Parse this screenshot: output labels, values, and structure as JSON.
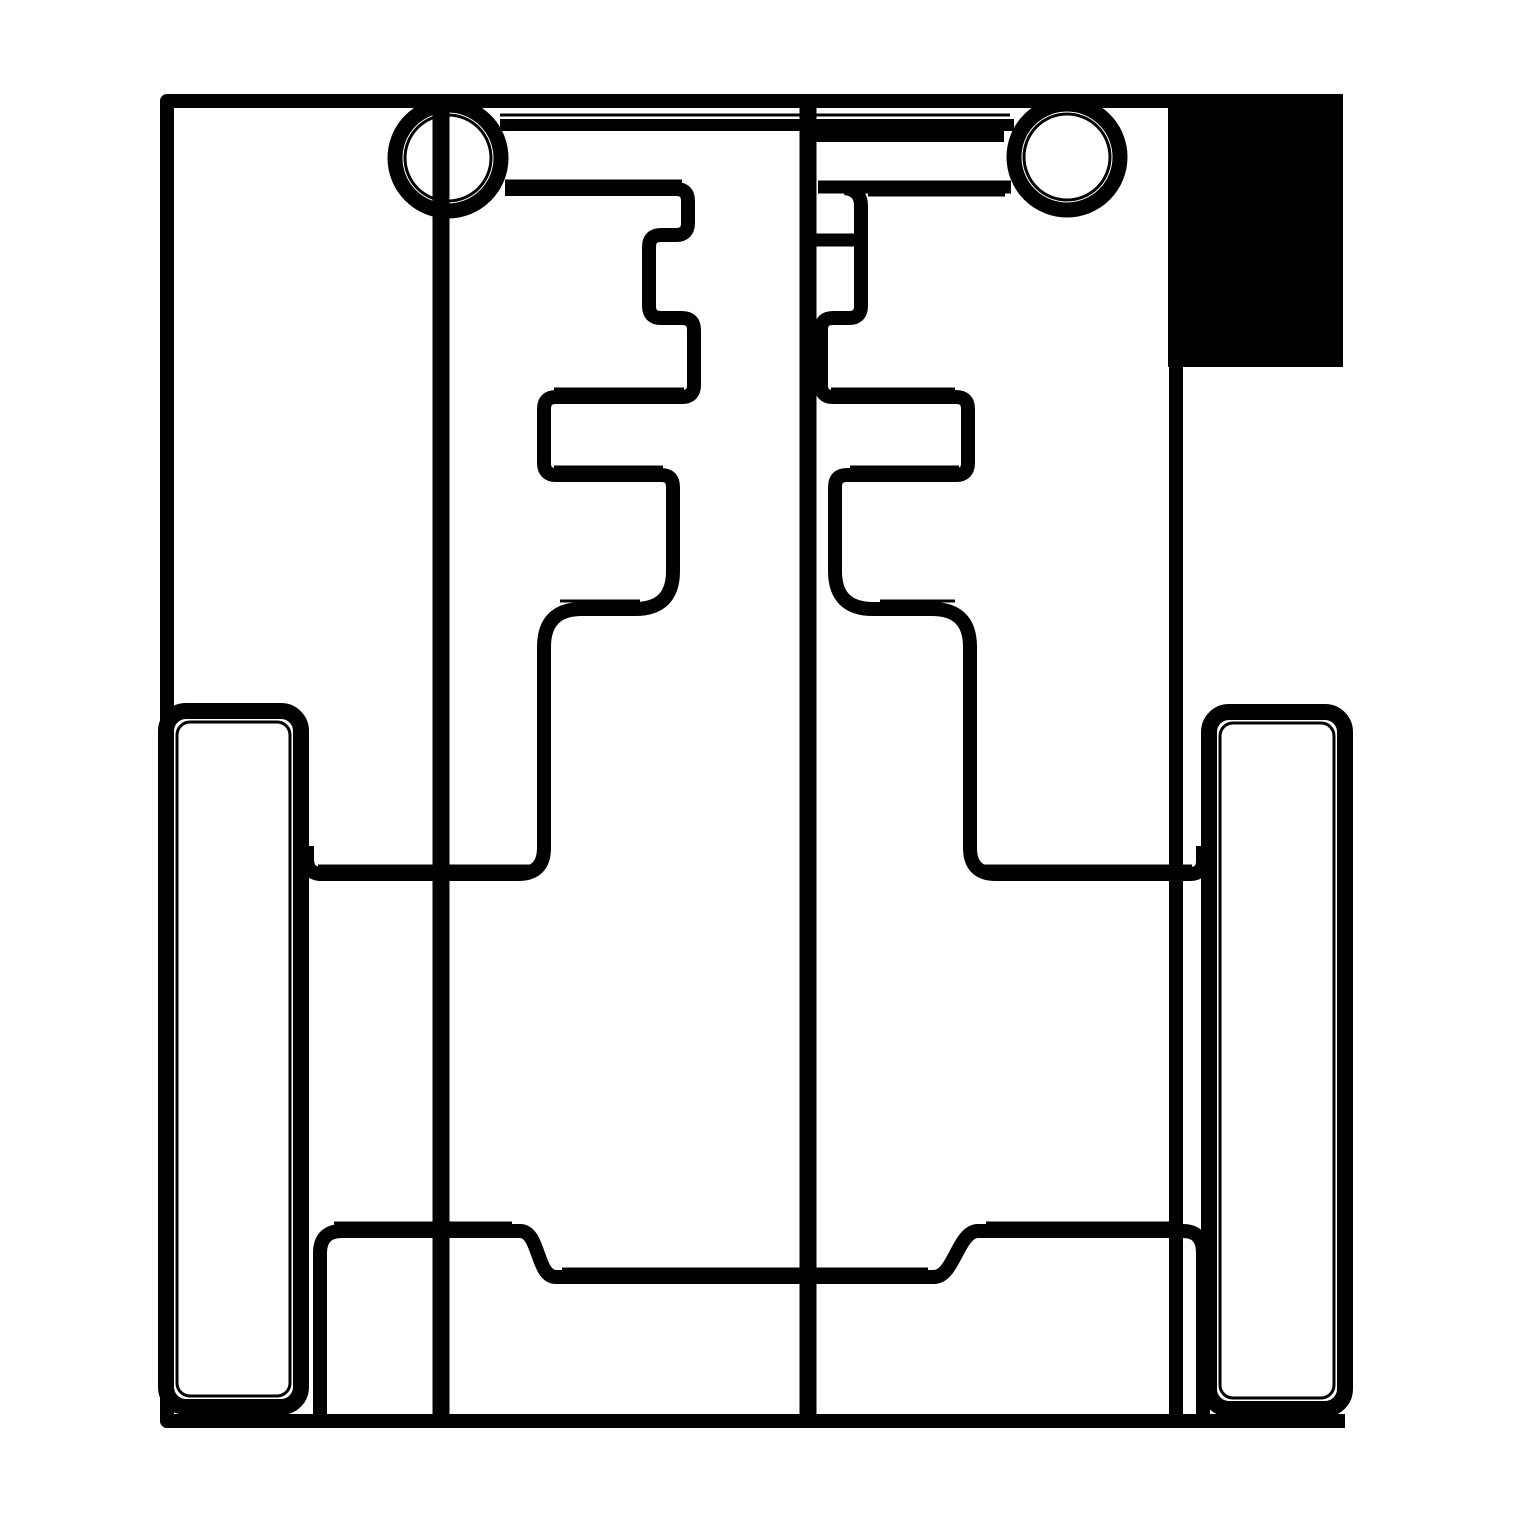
{
  "canvas": {
    "width": 1519,
    "height": 1519,
    "background_color": "#ffffff",
    "ink_color": "#000000"
  },
  "drawing": {
    "frame": {
      "outline": {
        "d": "M 1343 101 H 167 V 1421 H 1345",
        "w": 14
      },
      "right_border": {
        "d": "M 1176 360 V 1421",
        "w": 14
      },
      "corner_block": {
        "x": 1168,
        "y": 95,
        "width": 175,
        "height": 272
      }
    },
    "guides": {
      "center_line": {
        "d": "M 808 101 V 1421",
        "w": 17
      },
      "left_line": {
        "d": "M 441 101 V 1421",
        "w": 17
      }
    },
    "grommets": {
      "left_ring": {
        "cx": 448,
        "cy": 158,
        "r": 53,
        "w": 15
      },
      "left_inner": {
        "cx": 448,
        "cy": 158,
        "r": 43,
        "w": 3
      },
      "right_ring": {
        "cx": 1067,
        "cy": 157,
        "r": 53,
        "w": 15
      },
      "right_inner": {
        "cx": 1067,
        "cy": 157,
        "r": 43,
        "w": 3
      }
    },
    "straps": {
      "top_strap": {
        "d": "M 500 125 H 1014",
        "w": 12
      },
      "top_strap_seam": {
        "d": "M 500 115 H 1010",
        "w": 3
      },
      "right_strap": {
        "d": "M 816 136 H 1004",
        "w": 12
      },
      "right_strap_seam": {
        "d": "M 818 128 H 1000",
        "w": 3
      }
    },
    "zippers": {
      "left_profile": {
        "d": "M 505 189 H 676 Q 688 189 688 201 V 223 Q 688 235 676 235 H 661 Q 649 235 649 247 V 306 Q 649 318 661 318 H 682 Q 694 318 694 330 V 385 Q 694 397 682 397 H 556 Q 544 397 544 409 V 463 Q 544 475 556 475 H 661 Q 673 475 673 487 V 571 Q 673 609 635 609 H 582 Q 544 609 544 647 V 848 Q 544 874 518 874 H 322 Q 307 874 307 859 V 846",
        "w": 14
      },
      "right_top_edge": {
        "d": "M 818 187 H 1011",
        "w": 13
      },
      "right_profile": {
        "d": "M 845 188 Q 861 190 861 206 V 306 Q 861 318 849 318 H 833 Q 821 318 821 330 V 385 Q 821 397 833 397 H 956 Q 968 397 968 409 V 463 Q 968 475 956 475 H 847 Q 835 475 835 487 V 571 Q 835 609 873 609 H 932 Q 970 609 970 647 V 848 Q 970 874 996 874 H 1190 Q 1203 874 1203 861 V 846",
        "w": 14
      },
      "right_tab": {
        "d": "M 816 240 H 854",
        "w": 13
      },
      "seams": {
        "left_top": {
          "d": "M 505 181 H 682",
          "w": 3
        },
        "left_h397": {
          "d": "M 554 389 H 684",
          "w": 3
        },
        "left_h475": {
          "d": "M 554 467 H 663",
          "w": 3
        },
        "left_h609": {
          "d": "M 560 601 H 640",
          "w": 3
        },
        "left_h874": {
          "d": "M 318 866 H 534",
          "w": 3
        },
        "right_top": {
          "d": "M 868 195 H 1005",
          "w": 3
        },
        "right_h397": {
          "d": "M 831 389 H 955",
          "w": 3
        },
        "right_h475": {
          "d": "M 850 467 H 959",
          "w": 3
        },
        "right_h609": {
          "d": "M 880 601 H 955",
          "w": 3
        },
        "right_h874": {
          "d": "M 980 866 H 1192",
          "w": 3
        }
      }
    },
    "panels": {
      "left": {
        "x": 166,
        "y": 711,
        "width": 135,
        "height": 696,
        "rx": 20,
        "w": 16
      },
      "left_seam": {
        "x": 177,
        "y": 722,
        "width": 113,
        "height": 674,
        "rx": 13,
        "w": 3
      },
      "right": {
        "x": 1209,
        "y": 712,
        "width": 136,
        "height": 697,
        "rx": 20,
        "w": 16
      },
      "right_seam": {
        "x": 1220,
        "y": 723,
        "width": 114,
        "height": 675,
        "rx": 13,
        "w": 3
      }
    },
    "bottom": {
      "step_line": {
        "d": "M 320 1418 V 1253 Q 320 1231 342 1231 H 520 C 540 1231 536 1277 556 1277 H 934 C 954 1277 958 1231 978 1231 H 1183 Q 1203 1231 1203 1253 V 1418",
        "w": 14
      },
      "seam_left": {
        "d": "M 334 1223 H 512",
        "w": 3
      },
      "seam_mid": {
        "d": "M 562 1269 H 928",
        "w": 3
      },
      "seam_right": {
        "d": "M 986 1223 H 1179",
        "w": 3
      }
    }
  }
}
